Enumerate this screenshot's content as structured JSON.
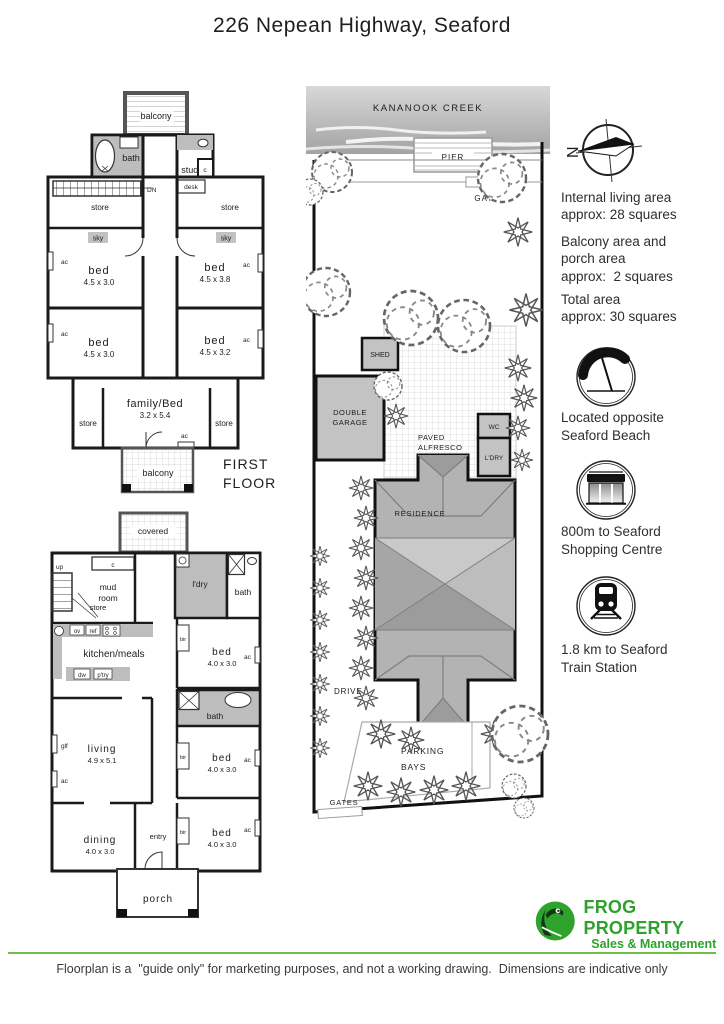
{
  "title": "226 Nepean Highway, Seaford",
  "first_floor": {
    "label_line1": "FIRST",
    "label_line2": "FLOOR",
    "balcony_top": "balcony",
    "balcony_bottom": "balcony",
    "bath": "bath",
    "study": "study",
    "closet": "c",
    "desk": "desk",
    "down_label": "DN",
    "store": "store",
    "sky": "sky",
    "ac": "ac",
    "beds": [
      {
        "name": "bed",
        "dims": "4.5 x 3.0"
      },
      {
        "name": "bed",
        "dims": "4.5 x 3.8"
      },
      {
        "name": "bed",
        "dims": "4.5 x 3.0"
      },
      {
        "name": "bed",
        "dims": "4.5 x 3.2"
      }
    ],
    "family": {
      "name": "family/Bed",
      "dims": "3.2 x 5.4"
    }
  },
  "ground_floor": {
    "covered": "covered",
    "closet": "c",
    "mud_line1": "mud",
    "mud_line2": "room",
    "up_label": "up",
    "store": "store",
    "laundry": "l'dry",
    "bath": "bath",
    "kitchen": {
      "label": "kitchen/meals",
      "ov": "ov",
      "ref": "ref",
      "dw": "dw",
      "pantry": "p'try"
    },
    "bir": "bir",
    "ac": "ac",
    "glf": "glf",
    "bed_top": {
      "name": "bed",
      "dims": "4.0 x 3.0"
    },
    "bed_mid": {
      "name": "bed",
      "dims": "4.0 x 3.0"
    },
    "bed_bottom": {
      "name": "bed",
      "dims": "4.0 x 3.0"
    },
    "living": {
      "name": "living",
      "dims": "4.9 x 5.1"
    },
    "dining": {
      "name": "dining",
      "dims": "4.0 x 3.0"
    },
    "entry": "entry",
    "porch": "porch"
  },
  "site_plan": {
    "creek": "KANANOOK CREEK",
    "pier": "PIER",
    "gate": "GATE",
    "shed": "SHED",
    "garage_line1": "DOUBLE",
    "garage_line2": "GARAGE",
    "alfresco_line1": "PAVED",
    "alfresco_line2": "ALFRESCO",
    "wc": "WC",
    "laundry": "L'DRY",
    "residence": "RESIDENCE",
    "drive": "DRIVE",
    "parking_line1": "PARKING",
    "parking_line2": "BAYS",
    "gates": "GATES"
  },
  "sidebar": {
    "compass_letter": "N",
    "areas": [
      "Internal living area\napprox: 28 squares",
      "Balcony area and\nporch area\napprox:  2 squares",
      "Total area\napprox: 30 squares"
    ],
    "store_sign": "STORE",
    "features": [
      {
        "icon": "beach-umbrella-icon",
        "text": "Located opposite\nSeaford Beach"
      },
      {
        "icon": "store-icon",
        "text": "800m to Seaford\nShopping Centre"
      },
      {
        "icon": "train-icon",
        "text": "1.8 km to Seaford\nTrain Station"
      }
    ]
  },
  "footer": {
    "brand": "FROG PROPERTY",
    "brand_sub": "Sales & Management",
    "disclaimer": "Floorplan is a  \"guide only\" for marketing purposes, and not a working drawing.  Dimensions are indicative only"
  },
  "colors": {
    "brand_green": "#2fa12d",
    "line_green": "#6cc04a",
    "wall_black": "#1a1a1a",
    "wet_area_gray": "#bdbdbd",
    "roof_gray": "#b3b3b3"
  }
}
